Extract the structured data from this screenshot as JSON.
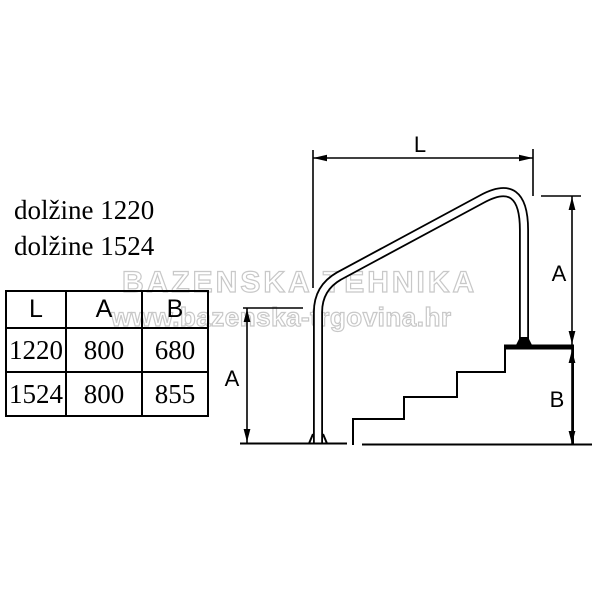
{
  "annotations": {
    "length_note_1": "dolžine 1220",
    "length_note_2": "dolžine 1524"
  },
  "watermark": {
    "brand": "BAZENSKA TEHNIKA",
    "url": "www.bazenska-trgovina.hr"
  },
  "spec_table": {
    "headers": [
      "L",
      "A",
      "B"
    ],
    "rows": [
      [
        "1220",
        "800",
        "680"
      ],
      [
        "1524",
        "800",
        "855"
      ]
    ]
  },
  "diagram": {
    "labels": {
      "length": "L",
      "rail_height_left": "A",
      "rail_height_right": "A",
      "deck_height": "B"
    }
  },
  "colors": {
    "line": "#000000",
    "watermark_outline": "#c8c8c8",
    "background": "#ffffff"
  }
}
